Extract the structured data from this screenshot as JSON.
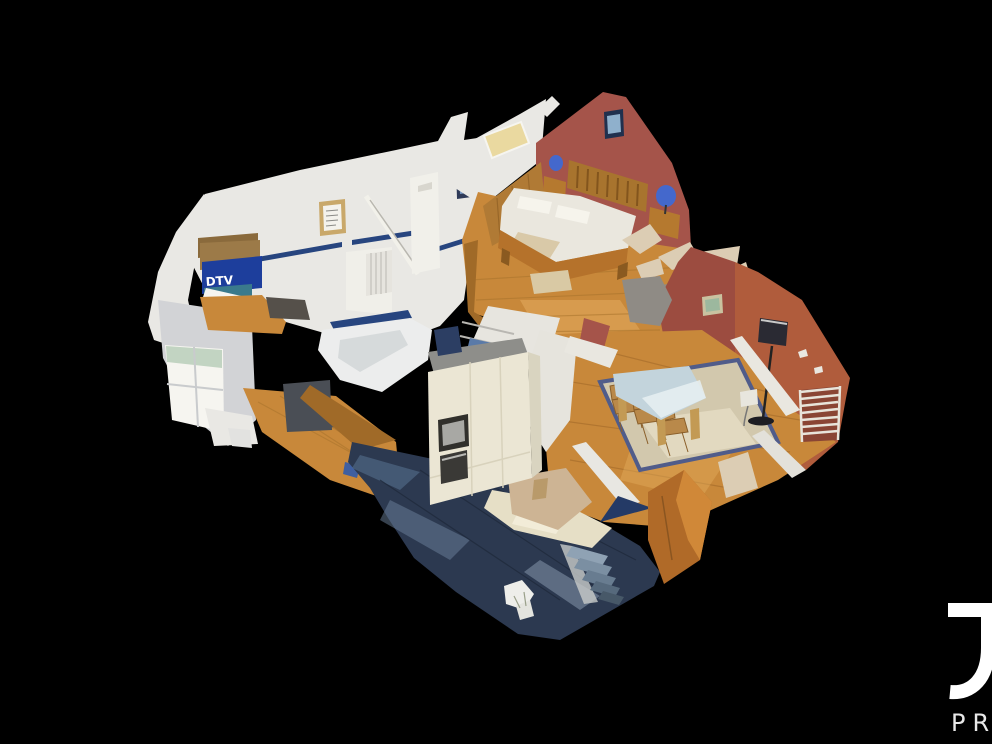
{
  "app": {
    "type": "3d-virtual-tour",
    "view": "dollhouse-cutaway"
  },
  "scene": {
    "box_label": "DTV"
  },
  "logo": {
    "letter": "J",
    "subtext": "PR"
  },
  "palette": {
    "bg": "#000000",
    "white-wall": "#e9e8e4",
    "white-bright": "#f6f5f0",
    "white-shadow": "#d2d3d6",
    "red-wall": "#a5544a",
    "red-orange": "#b05c3c",
    "wood": "#c8883a",
    "wood-light": "#e3ac5e",
    "wood-dark": "#a06a28",
    "blue-stripe": "#27457f",
    "box-blue": "#1d3e9c",
    "lamp-blue": "#4468cc",
    "dark-floor": "#2c3950",
    "cream": "#ebe6d4",
    "rug": "#d2c8ad",
    "rug-border": "#505c8a",
    "table-top": "#c3d4dc",
    "sun-patch": "#e6dfc6",
    "fragment": "#dccdb4",
    "logo": "#ffffff",
    "logo-sub": "#e8e8e8"
  }
}
